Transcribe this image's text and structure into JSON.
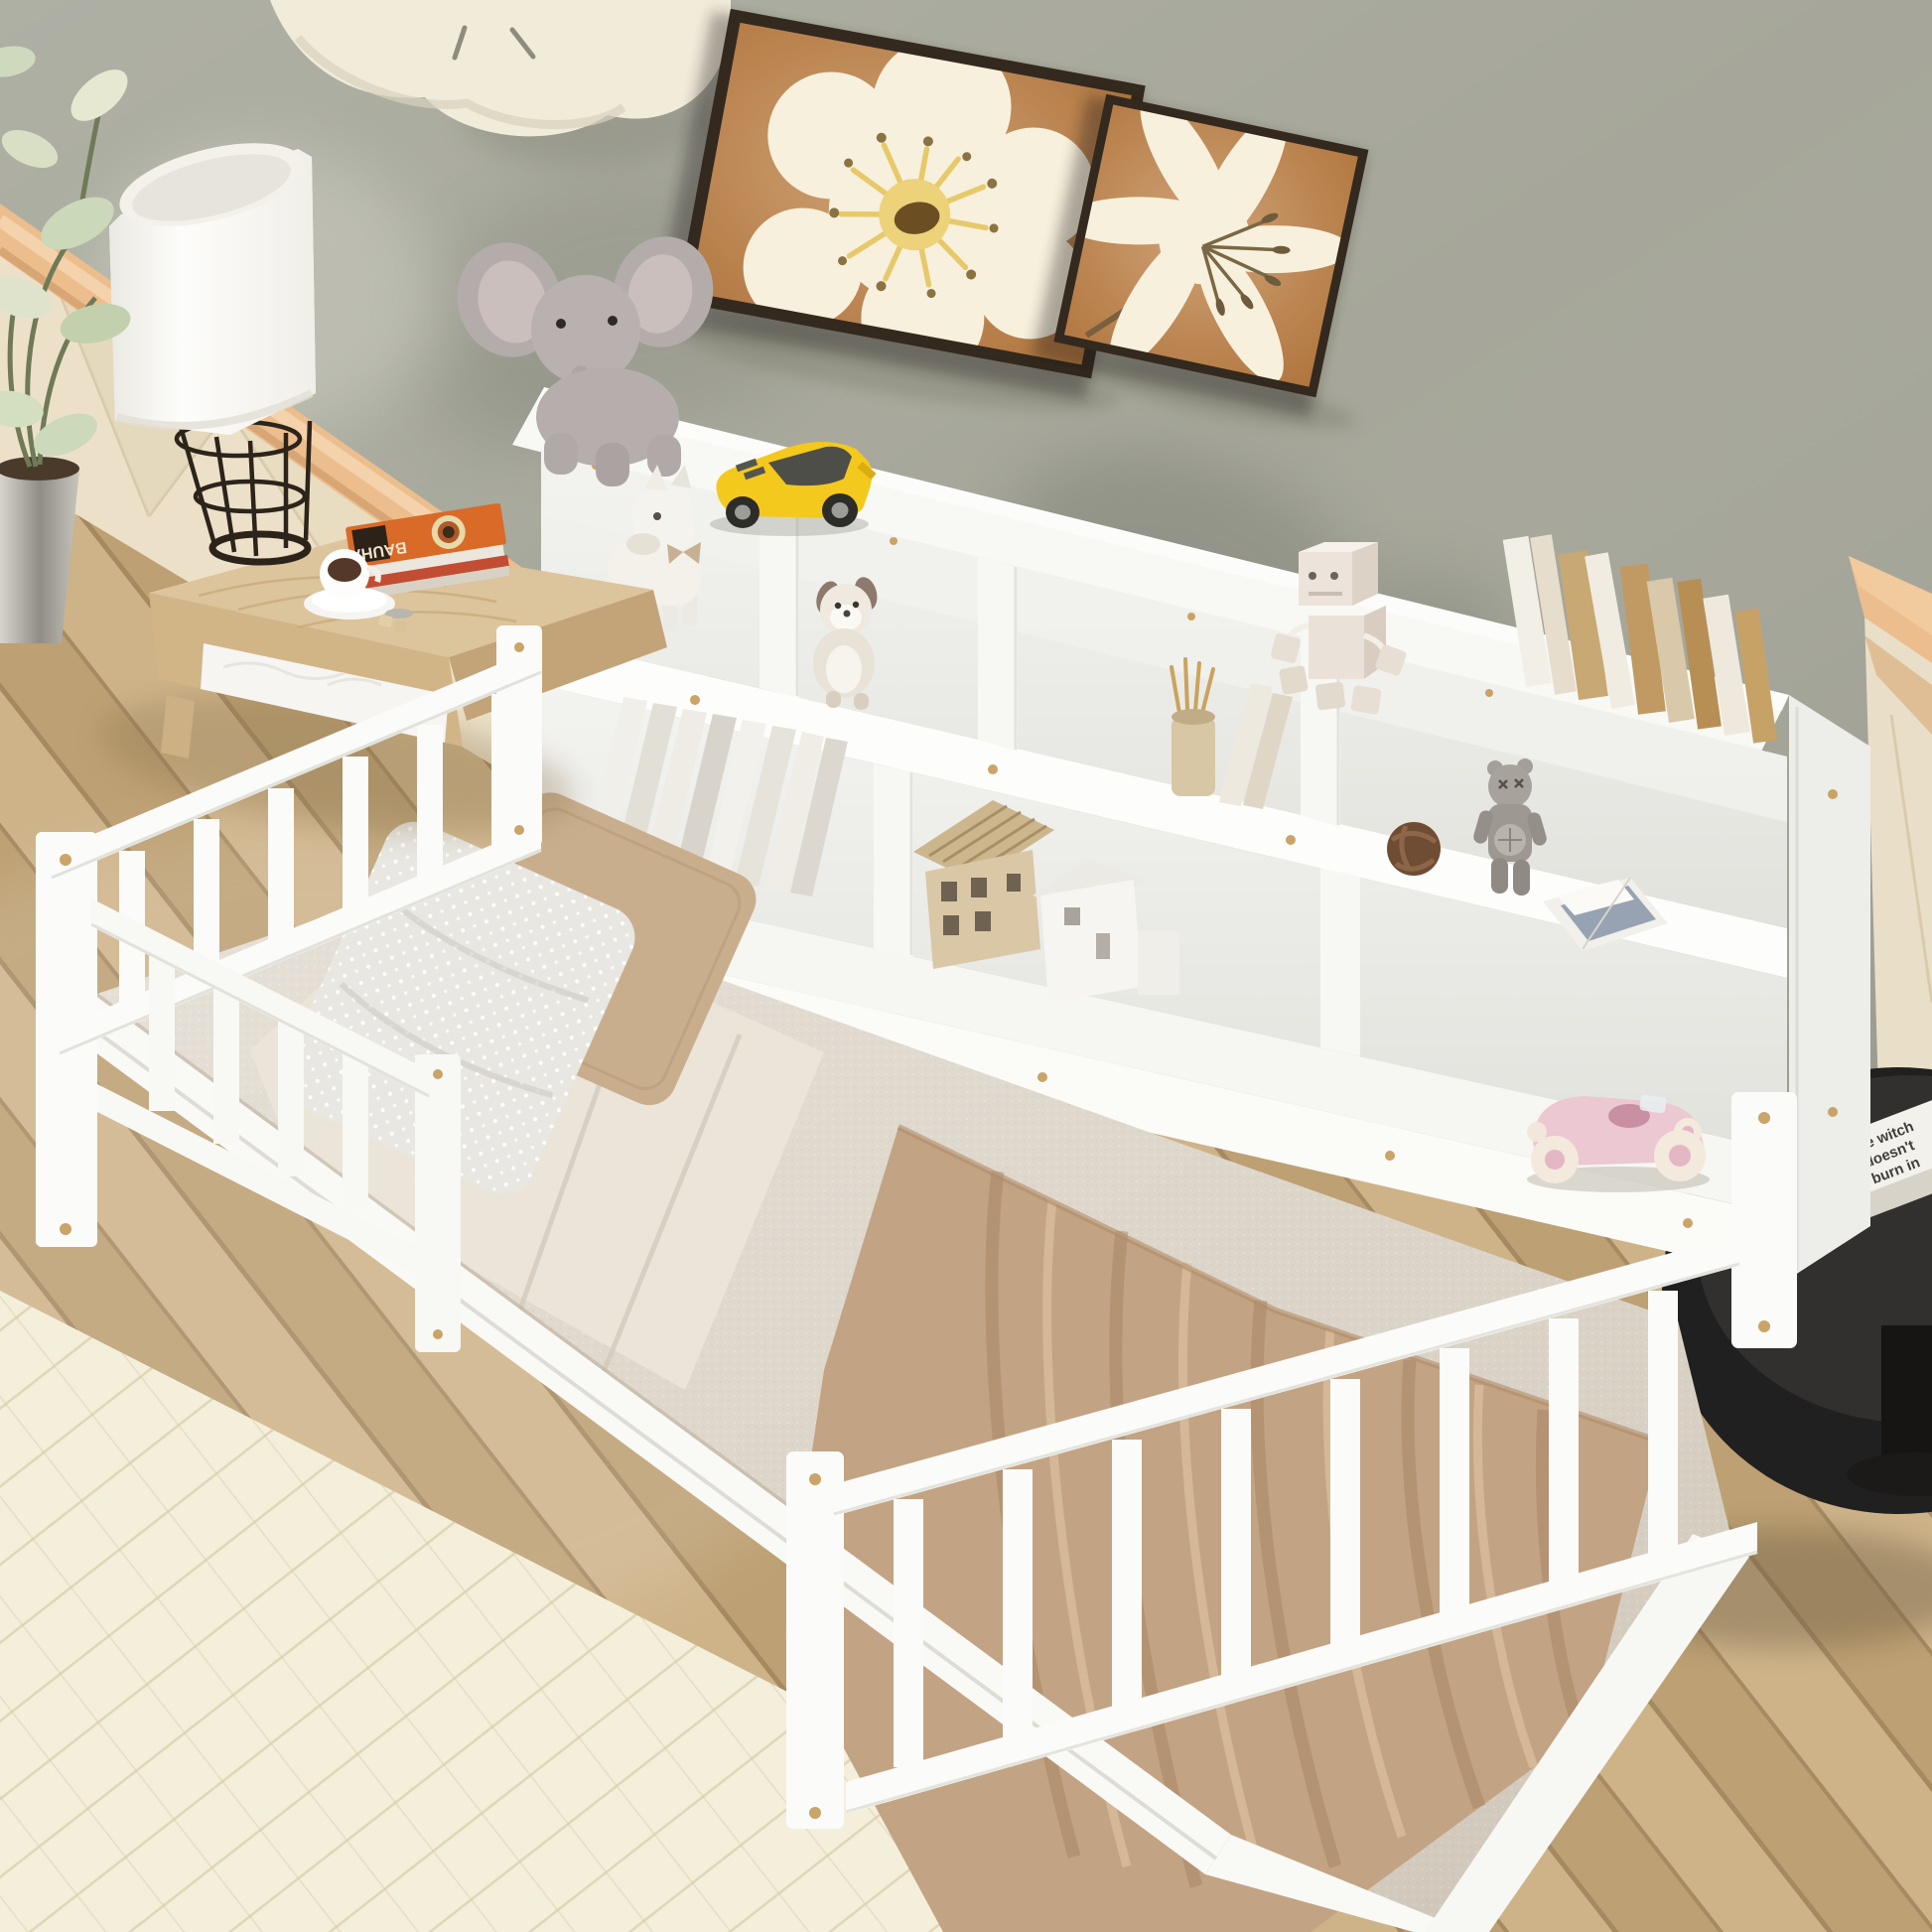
{
  "scene": {
    "type": "product-photo",
    "setting": "kids bedroom, top-down three-quarter view",
    "subject": "white twin floor daybed with bookcase storage headboard and safety guard rails",
    "text": {
      "nightstand_book_spine": "BAUHAUS",
      "side_table_book": [
        "the witch",
        "doesn't",
        "burn in"
      ]
    },
    "palette": {
      "wall": "#a6a79a",
      "wall_shadow": "#7e7f74",
      "clock_cream": "#f1ebdA",
      "painting_bg": "#c08145",
      "painting_frame": "#33291f",
      "flower_cream": "#f7f0dd",
      "flower_yellow": "#eed27a",
      "flower_center": "#6b4f23",
      "headboard_roll": "#ecbe8e",
      "headboard_pad": "#ece1c8",
      "floor_wood": "#c8aa7c",
      "rug": "#f4efdb",
      "bookcase_white": "#f8f8f5",
      "shelf_interior": "#e9e9e4",
      "mattress": "#d9d1c4",
      "sheet": "#ebe5d9",
      "pillow_dotted": "#e8e7e2",
      "pillow_tan": "#c9ae8e",
      "blanket": "#c2a383",
      "nightstand_wood": "#dcc49c",
      "drawer_white": "#f6f5f1",
      "lamp_shade": "#fbfaf6",
      "lamp_base": "#2c241b",
      "plant_leaf": "#ccd8ba",
      "plant_pot": "#b9b7ad",
      "toy_car_yellow": "#f3c91d",
      "toy_car_pink": "#ecc8d2",
      "plush_gray": "#b4acab",
      "plush_cream": "#f3f1ea",
      "robot_cream": "#ece4da",
      "book_tan": "#c8a873",
      "book_white": "#f3f0e8",
      "kaws_gray": "#a39e97",
      "knot_ball_brown": "#6f4c34",
      "table_black": "#212020",
      "gold_screw": "#c49a58",
      "coffee": "#54382a",
      "bauhaus_orange": "#d96a28"
    },
    "objects": [
      "white floor daybed with guard rails",
      "bookcase storage headboard with cubbies",
      "beige boucle mattress",
      "white dotted pillow",
      "tan pillow",
      "tan throw blanket",
      "plush elephant",
      "plush horse",
      "plush puppy",
      "yellow toy sports car",
      "wooden robot figurine",
      "pink vintage toy car",
      "toy house models",
      "row of standing books",
      "leaning books",
      "pencil cup with pencils",
      "gray collectible figure",
      "brown knot ball",
      "open magazine",
      "cloud wall clock",
      "two framed flower art prints",
      "floor lamp with wire base",
      "light wood nightstand",
      "BAUHAUS book stack",
      "coffee cup with saucer and sugar",
      "potted plant",
      "black round side table with books",
      "light oak plank floor",
      "cream area rug",
      "padded headboard wall panel"
    ]
  }
}
